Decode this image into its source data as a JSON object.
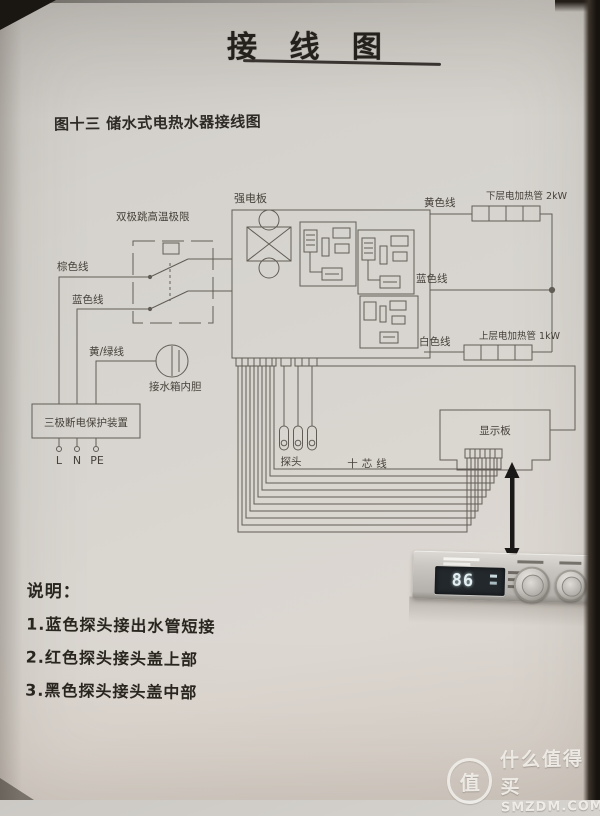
{
  "page": {
    "title": "接 线 图",
    "caption": "图十三 储水式电热水器接线图"
  },
  "diagram": {
    "labels": {
      "power_board": "强电板",
      "thermostat_limit": "双极跳高温极限",
      "brown_wire": "棕色线",
      "blue_wire_left": "蓝色线",
      "yellow_green_wire": "黄/绿线",
      "tank_liner": "接水箱内胆",
      "protector": "三极断电保护装置",
      "term_l": "L",
      "term_n": "N",
      "term_pe": "PE",
      "yellow_wire": "黄色线",
      "lower_heater": "下层电加热管 2kW",
      "blue_wire_right": "蓝色线",
      "white_wire": "白色线",
      "upper_heater": "上层电加热管 1kW",
      "display_board": "显示板",
      "probes": "探头",
      "ten_core": "十芯线"
    }
  },
  "notes": {
    "heading": "说明：",
    "items": [
      "1.蓝色探头接出水管短接",
      "2.红色探头接头盖上部",
      "3.黑色探头接头盖中部"
    ]
  },
  "panel": {
    "display_value": "86"
  },
  "watermark": {
    "badge": "值",
    "name": "什么值得买",
    "site": "SMZDM.COM"
  },
  "colors": {
    "paper": "#d7d3ce",
    "line": "#615d56",
    "ink": "#39352f",
    "display_bg": "#23282c",
    "display_text": "#e4eff2"
  }
}
